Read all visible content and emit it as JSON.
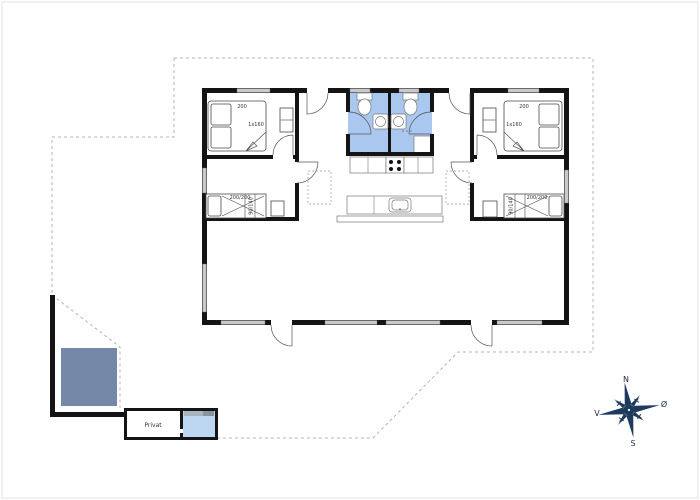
{
  "rooms": {
    "bedroom_top_left": {
      "bed_label": "200",
      "bed_size": "1x160"
    },
    "bedroom_top_right": {
      "bed_label": "200",
      "bed_size": "1x160"
    },
    "bedroom_mid_left": {
      "bunk_label": "200/200",
      "bunk_side_label": "90/140"
    },
    "bedroom_mid_right": {
      "bunk_label": "200/200",
      "bunk_side_label": "90/140"
    },
    "annex": {
      "label": "Privat"
    }
  },
  "compass": {
    "north": "N",
    "east": "Ø",
    "south": "S",
    "west": "V"
  },
  "colors": {
    "bathroom_blue": "#a9c7ef",
    "annex_bath_blue": "#bdd7f3",
    "terrace_blue": "#7588a8",
    "wall_black": "#141414",
    "window_gray": "#c9c9c9",
    "boundary_gray": "#b4b4b4",
    "compass_navy": "#1e3a5f"
  }
}
